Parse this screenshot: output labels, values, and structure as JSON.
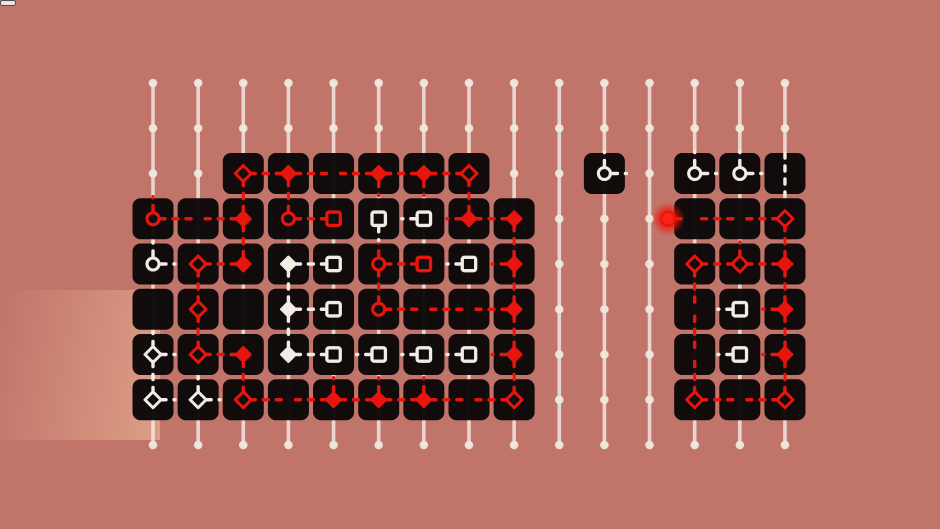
{
  "app": {
    "name": "cozy-room-line-puzzle",
    "text_content": "none (icon-only game UI)"
  },
  "menu": {
    "icon": "grid-menu-icon",
    "rows": 3,
    "cols": 3,
    "square_color": "#f6f3ee"
  },
  "panel": {
    "x": 130,
    "y": 73,
    "w": 680,
    "h": 380,
    "radius": 34,
    "color": "rgba(14,9,7,0.40)"
  },
  "board": {
    "cols": 15,
    "rows": 9,
    "origin_x": 153,
    "origin_y": 83,
    "dx": 45.14,
    "dy": 45.25,
    "colors": {
      "red": "#e8150e",
      "red_bright": "#ff2317",
      "white": "#f2ece4",
      "tile": "#0b0808",
      "dot": "#efe8dd",
      "line": "#f4eee6"
    },
    "tile_size": 41,
    "tile_radius": 8,
    "tiles": {
      "2": [
        2,
        3,
        4,
        5,
        6,
        7,
        10,
        12,
        13,
        14
      ],
      "3": [
        0,
        1,
        2,
        3,
        4,
        5,
        6,
        7,
        8,
        12,
        13,
        14
      ],
      "4": [
        0,
        1,
        2,
        3,
        4,
        5,
        6,
        7,
        8,
        12,
        13,
        14
      ],
      "5": [
        0,
        1,
        2,
        3,
        4,
        5,
        6,
        7,
        8,
        12,
        13,
        14
      ],
      "6": [
        0,
        1,
        2,
        3,
        4,
        5,
        6,
        7,
        8,
        12,
        13,
        14
      ],
      "7": [
        0,
        1,
        2,
        3,
        4,
        5,
        6,
        7,
        8,
        12,
        13,
        14
      ]
    },
    "edges": [
      [
        2,
        2,
        3,
        2,
        "R"
      ],
      [
        3,
        2,
        4,
        2,
        "R"
      ],
      [
        4,
        2,
        5,
        2,
        "R"
      ],
      [
        5,
        2,
        6,
        2,
        "R"
      ],
      [
        6,
        2,
        7,
        2,
        "R"
      ],
      [
        2,
        2,
        2,
        3,
        "R"
      ],
      [
        3,
        2,
        3,
        3,
        "R"
      ],
      [
        7,
        2,
        7,
        3,
        "R"
      ],
      [
        0,
        3,
        1,
        3,
        "R"
      ],
      [
        1,
        3,
        2,
        3,
        "R"
      ],
      [
        3,
        3,
        4,
        3,
        "R"
      ],
      [
        7,
        3,
        8,
        3,
        "R"
      ],
      [
        2,
        3,
        2,
        4,
        "R"
      ],
      [
        8,
        3,
        8,
        4,
        "R"
      ],
      [
        8,
        4,
        8,
        5,
        "R"
      ],
      [
        8,
        5,
        8,
        6,
        "R"
      ],
      [
        8,
        6,
        8,
        7,
        "R"
      ],
      [
        1,
        4,
        2,
        4,
        "R"
      ],
      [
        5,
        4,
        6,
        4,
        "R"
      ],
      [
        1,
        4,
        1,
        5,
        "R"
      ],
      [
        1,
        5,
        1,
        6,
        "R"
      ],
      [
        5,
        4,
        5,
        5,
        "R"
      ],
      [
        5,
        5,
        6,
        5,
        "R"
      ],
      [
        6,
        5,
        7,
        5,
        "R"
      ],
      [
        7,
        5,
        8,
        5,
        "R"
      ],
      [
        1,
        6,
        2,
        6,
        "R"
      ],
      [
        2,
        6,
        2,
        7,
        "R"
      ],
      [
        2,
        7,
        3,
        7,
        "R"
      ],
      [
        3,
        7,
        4,
        7,
        "R"
      ],
      [
        4,
        7,
        5,
        7,
        "R"
      ],
      [
        5,
        7,
        6,
        7,
        "R"
      ],
      [
        6,
        7,
        7,
        7,
        "R"
      ],
      [
        7,
        7,
        8,
        7,
        "R"
      ],
      [
        12,
        3,
        13,
        3,
        "R"
      ],
      [
        13,
        3,
        14,
        3,
        "R"
      ],
      [
        14,
        3,
        14,
        4,
        "R"
      ],
      [
        14,
        4,
        14,
        5,
        "R"
      ],
      [
        14,
        5,
        14,
        6,
        "R"
      ],
      [
        14,
        6,
        14,
        7,
        "R"
      ],
      [
        12,
        4,
        13,
        4,
        "R"
      ],
      [
        13,
        4,
        14,
        4,
        "R"
      ],
      [
        12,
        4,
        12,
        5,
        "R"
      ],
      [
        12,
        5,
        12,
        6,
        "R"
      ],
      [
        12,
        6,
        12,
        7,
        "R"
      ],
      [
        12,
        7,
        13,
        7,
        "R"
      ],
      [
        13,
        7,
        14,
        7,
        "R"
      ],
      [
        3,
        4,
        4,
        4,
        "W"
      ],
      [
        3,
        5,
        4,
        5,
        "W"
      ],
      [
        3,
        6,
        4,
        6,
        "W"
      ],
      [
        3,
        4,
        3,
        5,
        "W"
      ],
      [
        3,
        5,
        3,
        6,
        "W"
      ],
      [
        0,
        6,
        0,
        7,
        "W"
      ]
    ],
    "stubs": [
      [
        0,
        3,
        "N",
        "R"
      ],
      [
        5,
        2,
        "S",
        "R"
      ],
      [
        6,
        2,
        "S",
        "R"
      ],
      [
        5,
        4,
        "N",
        "R"
      ],
      [
        8,
        4,
        "W",
        "R"
      ],
      [
        8,
        6,
        "W",
        "R"
      ],
      [
        4,
        7,
        "N",
        "R"
      ],
      [
        5,
        7,
        "N",
        "R"
      ],
      [
        6,
        7,
        "N",
        "R"
      ],
      [
        7,
        3,
        "W",
        "R"
      ],
      [
        13,
        4,
        "N",
        "R"
      ],
      [
        14,
        5,
        "W",
        "R"
      ],
      [
        14,
        6,
        "W",
        "R"
      ],
      [
        0,
        4,
        "N",
        "W"
      ],
      [
        0,
        4,
        "E",
        "W"
      ],
      [
        0,
        6,
        "N",
        "W"
      ],
      [
        0,
        6,
        "E",
        "W"
      ],
      [
        0,
        7,
        "E",
        "W"
      ],
      [
        1,
        7,
        "N",
        "W"
      ],
      [
        1,
        7,
        "E",
        "W"
      ],
      [
        10,
        2,
        "N",
        "W"
      ],
      [
        10,
        2,
        "E",
        "W"
      ],
      [
        12,
        2,
        "N",
        "W"
      ],
      [
        12,
        2,
        "E",
        "W"
      ],
      [
        13,
        2,
        "N",
        "W"
      ],
      [
        13,
        2,
        "E",
        "W"
      ],
      [
        5,
        3,
        "S",
        "W"
      ],
      [
        6,
        3,
        "W",
        "W"
      ],
      [
        7,
        4,
        "W",
        "W"
      ],
      [
        5,
        6,
        "W",
        "W"
      ],
      [
        6,
        6,
        "W",
        "W"
      ],
      [
        7,
        6,
        "W",
        "W"
      ],
      [
        13,
        5,
        "W",
        "W"
      ],
      [
        13,
        6,
        "W",
        "W"
      ],
      [
        14,
        2,
        "NS",
        "W"
      ]
    ],
    "markers": [
      [
        2,
        2,
        "diamond_outline",
        "R"
      ],
      [
        3,
        2,
        "diamond",
        "R"
      ],
      [
        5,
        2,
        "diamond",
        "R"
      ],
      [
        6,
        2,
        "diamond",
        "R"
      ],
      [
        7,
        2,
        "diamond_outline",
        "R"
      ],
      [
        10,
        2,
        "circle_outline",
        "W"
      ],
      [
        12,
        2,
        "circle_outline",
        "W"
      ],
      [
        13,
        2,
        "circle_outline",
        "W"
      ],
      [
        0,
        3,
        "circle_outline",
        "R"
      ],
      [
        2,
        3,
        "diamond",
        "R"
      ],
      [
        3,
        3,
        "circle_outline",
        "R"
      ],
      [
        4,
        3,
        "square_outline",
        "R"
      ],
      [
        5,
        3,
        "square_outline",
        "W"
      ],
      [
        6,
        3,
        "square_outline",
        "W"
      ],
      [
        7,
        3,
        "diamond",
        "R"
      ],
      [
        8,
        3,
        "diamond",
        "R"
      ],
      [
        14,
        3,
        "diamond_outline",
        "R"
      ],
      [
        0,
        4,
        "circle_outline",
        "W"
      ],
      [
        1,
        4,
        "diamond_outline",
        "R"
      ],
      [
        2,
        4,
        "diamond",
        "R"
      ],
      [
        3,
        4,
        "diamond",
        "W"
      ],
      [
        4,
        4,
        "square_outline",
        "W"
      ],
      [
        5,
        4,
        "circle_outline",
        "R"
      ],
      [
        6,
        4,
        "square_outline",
        "R"
      ],
      [
        7,
        4,
        "square_outline",
        "W"
      ],
      [
        8,
        4,
        "diamond",
        "R"
      ],
      [
        12,
        4,
        "diamond_outline",
        "R"
      ],
      [
        13,
        4,
        "diamond_outline",
        "R"
      ],
      [
        14,
        4,
        "diamond",
        "R"
      ],
      [
        1,
        5,
        "diamond_outline",
        "R"
      ],
      [
        3,
        5,
        "diamond",
        "W"
      ],
      [
        4,
        5,
        "square_outline",
        "W"
      ],
      [
        5,
        5,
        "circle_outline",
        "R"
      ],
      [
        8,
        5,
        "diamond",
        "R"
      ],
      [
        13,
        5,
        "square_outline",
        "W"
      ],
      [
        14,
        5,
        "diamond",
        "R"
      ],
      [
        0,
        6,
        "diamond_outline",
        "W"
      ],
      [
        1,
        6,
        "diamond_outline",
        "R"
      ],
      [
        2,
        6,
        "diamond",
        "R"
      ],
      [
        3,
        6,
        "diamond",
        "W"
      ],
      [
        4,
        6,
        "square_outline",
        "W"
      ],
      [
        5,
        6,
        "square_outline",
        "W"
      ],
      [
        6,
        6,
        "square_outline",
        "W"
      ],
      [
        7,
        6,
        "square_outline",
        "W"
      ],
      [
        8,
        6,
        "diamond",
        "R"
      ],
      [
        13,
        6,
        "square_outline",
        "W"
      ],
      [
        14,
        6,
        "diamond",
        "R"
      ],
      [
        0,
        7,
        "diamond_outline",
        "W"
      ],
      [
        1,
        7,
        "diamond_outline",
        "W"
      ],
      [
        2,
        7,
        "diamond_outline",
        "R"
      ],
      [
        4,
        7,
        "diamond",
        "R"
      ],
      [
        5,
        7,
        "diamond",
        "R"
      ],
      [
        6,
        7,
        "diamond",
        "R"
      ],
      [
        8,
        7,
        "diamond_outline",
        "R"
      ],
      [
        12,
        7,
        "diamond_outline",
        "R"
      ],
      [
        14,
        7,
        "diamond_outline",
        "R"
      ]
    ],
    "glow_end": {
      "x": 668,
      "row": 3,
      "to_col": 12
    }
  },
  "background": {
    "description": "illustrated cozy room: plant, framed pictures, clock, window with curtain, bookshelf, TV, easel, couch, door, rugs, wooden floor, white cat rug",
    "palette": {
      "wall": "#c4756b",
      "window_light": "#f7e1aa",
      "bookshelf": "#3d241b",
      "door": "#ead8bc",
      "floor": "#d28c55",
      "pink_rug": "#cf8794",
      "cat_rug": "#f2dfc7"
    }
  }
}
